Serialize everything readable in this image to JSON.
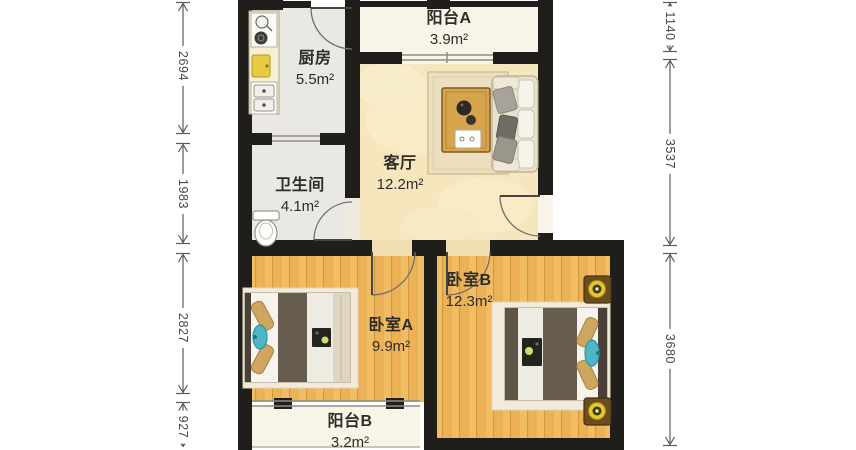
{
  "plan": {
    "type": "apartment-floor-plan",
    "rooms": [
      {
        "id": "balcony-a",
        "name": "阳台A",
        "area": "3.9m²"
      },
      {
        "id": "kitchen",
        "name": "厨房",
        "area": "5.5m²"
      },
      {
        "id": "living-room",
        "name": "客厅",
        "area": "12.2m²"
      },
      {
        "id": "bathroom",
        "name": "卫生间",
        "area": "4.1m²"
      },
      {
        "id": "bedroom-a",
        "name": "卧室A",
        "area": "9.9m²"
      },
      {
        "id": "bedroom-b",
        "name": "卧室B",
        "area": "12.3m²"
      },
      {
        "id": "balcony-b",
        "name": "阳台B",
        "area": "3.2m²"
      }
    ],
    "dimensions": {
      "left": [
        {
          "value": "2694"
        },
        {
          "value": "1983"
        },
        {
          "value": "2827"
        },
        {
          "value": "927"
        }
      ],
      "right": [
        {
          "value": "1140"
        },
        {
          "value": "3537"
        },
        {
          "value": "3680"
        }
      ]
    },
    "colors": {
      "wall": "#201e1b",
      "wood_floor": "#f1bc62",
      "living_floor": "#f5e6bd",
      "tile_floor": "#eae8e2",
      "balcony_floor": "#f8f4e8",
      "accent_teal_pillow": "#4db5c4",
      "lamp_yellow": "#e7c634",
      "blanket_taupe": "#675d4e"
    }
  }
}
